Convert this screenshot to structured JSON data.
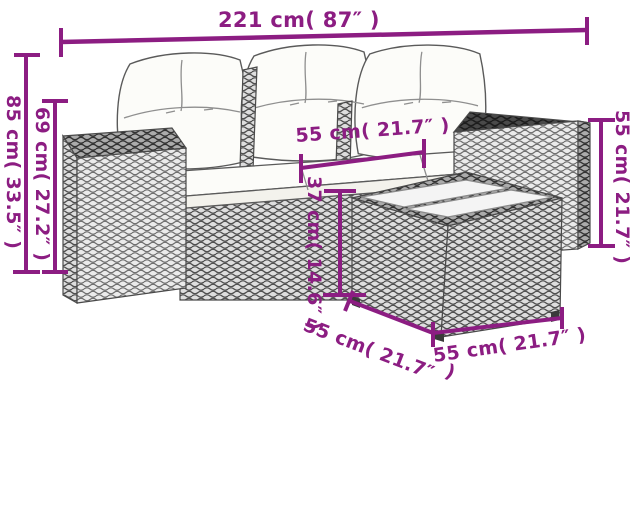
{
  "diagram": {
    "type": "product-dimension-diagram",
    "subject": "rattan garden sofa set with table"
  },
  "labels": {
    "overall_width": "221 cm( 87″ )",
    "back_height": "85 cm( 33.5″ )",
    "arm_height": "69 cm( 27.2″ )",
    "seat_depth": "55 cm( 21.7″ )",
    "table_height": "37 cm( 14.6″ )",
    "arm_right_height": "55 cm( 21.7″ )",
    "table_left_edge": "55 cm( 21.7″",
    "table_left_edge_wrap": ")",
    "table_right_edge": "55 cm( 21.7″ )"
  },
  "colors": {
    "dimension": "#8C1D82",
    "furniture_outline": "#4a4a4a",
    "cushion": "#fcfcf9",
    "wicker_light": "#ebebeb",
    "wicker_medium": "#d9d9d9",
    "wicker_dark": "#474747",
    "background": "#ffffff"
  }
}
